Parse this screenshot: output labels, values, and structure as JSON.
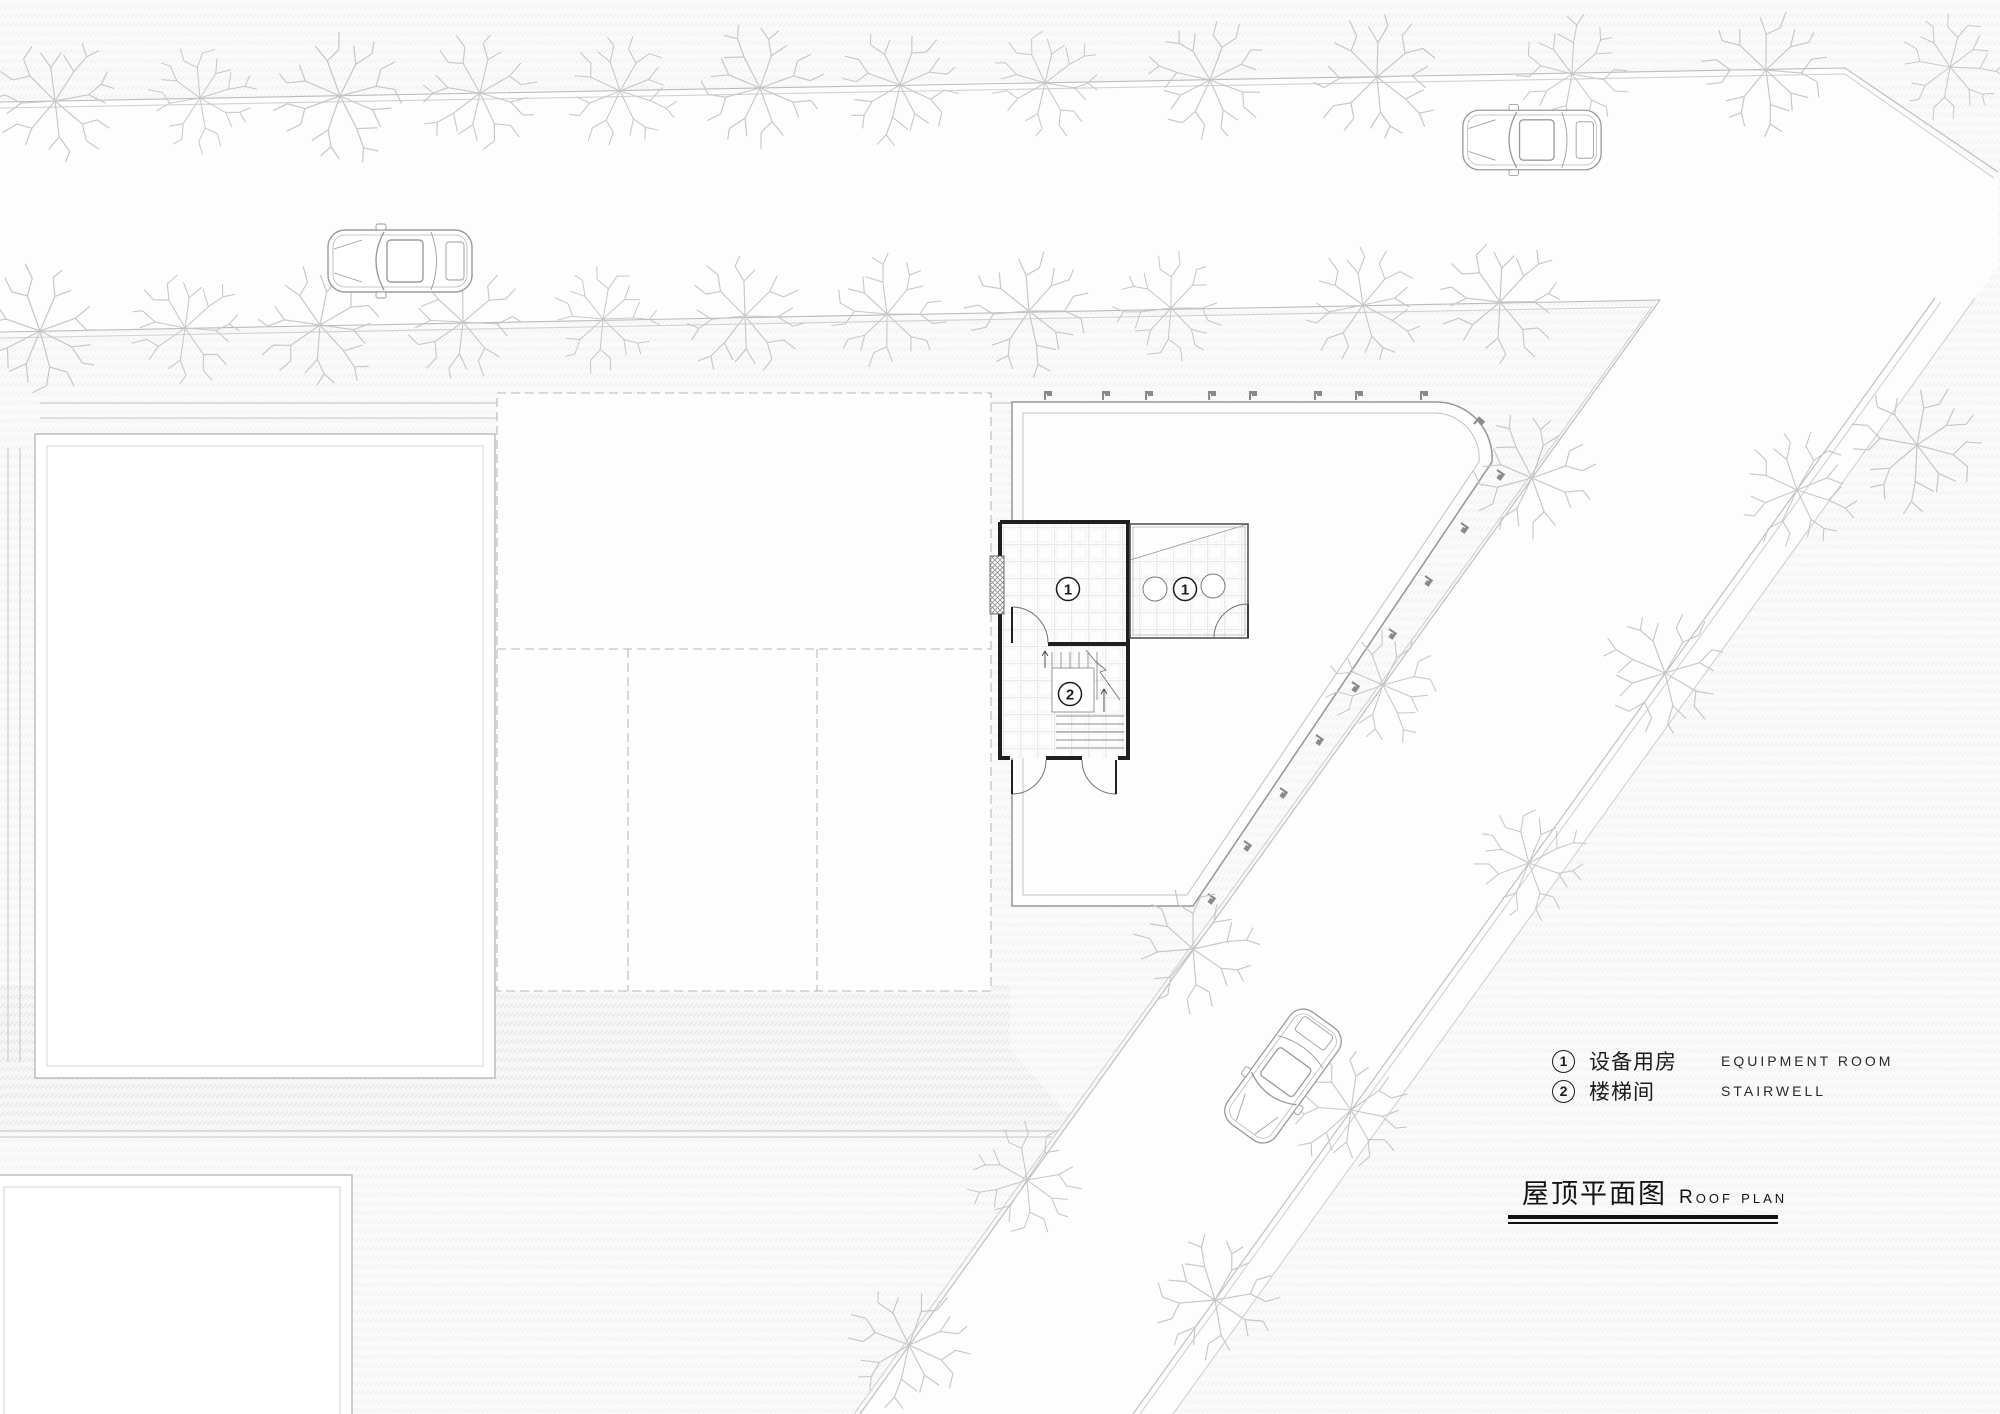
{
  "plan": {
    "markers": [
      {
        "label": "1"
      },
      {
        "label": "1"
      },
      {
        "label": "2"
      }
    ]
  },
  "legend": {
    "items": [
      {
        "symbol": "1",
        "zh": "设备用房",
        "en": "EQUIPMENT ROOM"
      },
      {
        "symbol": "2",
        "zh": "楼梯间",
        "en": "STAIRWELL"
      }
    ]
  },
  "title": {
    "zh": "屋顶平面图",
    "en": "Roof plan"
  },
  "colors": {
    "wall": "#1f1f1f",
    "roof_line": "#9a9a9a",
    "road_line": "#bcbcbc",
    "tree": "#c7c7c7",
    "car": "#9b9b9b",
    "dash_line": "#b9b9b9",
    "text": "#1c1c1c"
  }
}
